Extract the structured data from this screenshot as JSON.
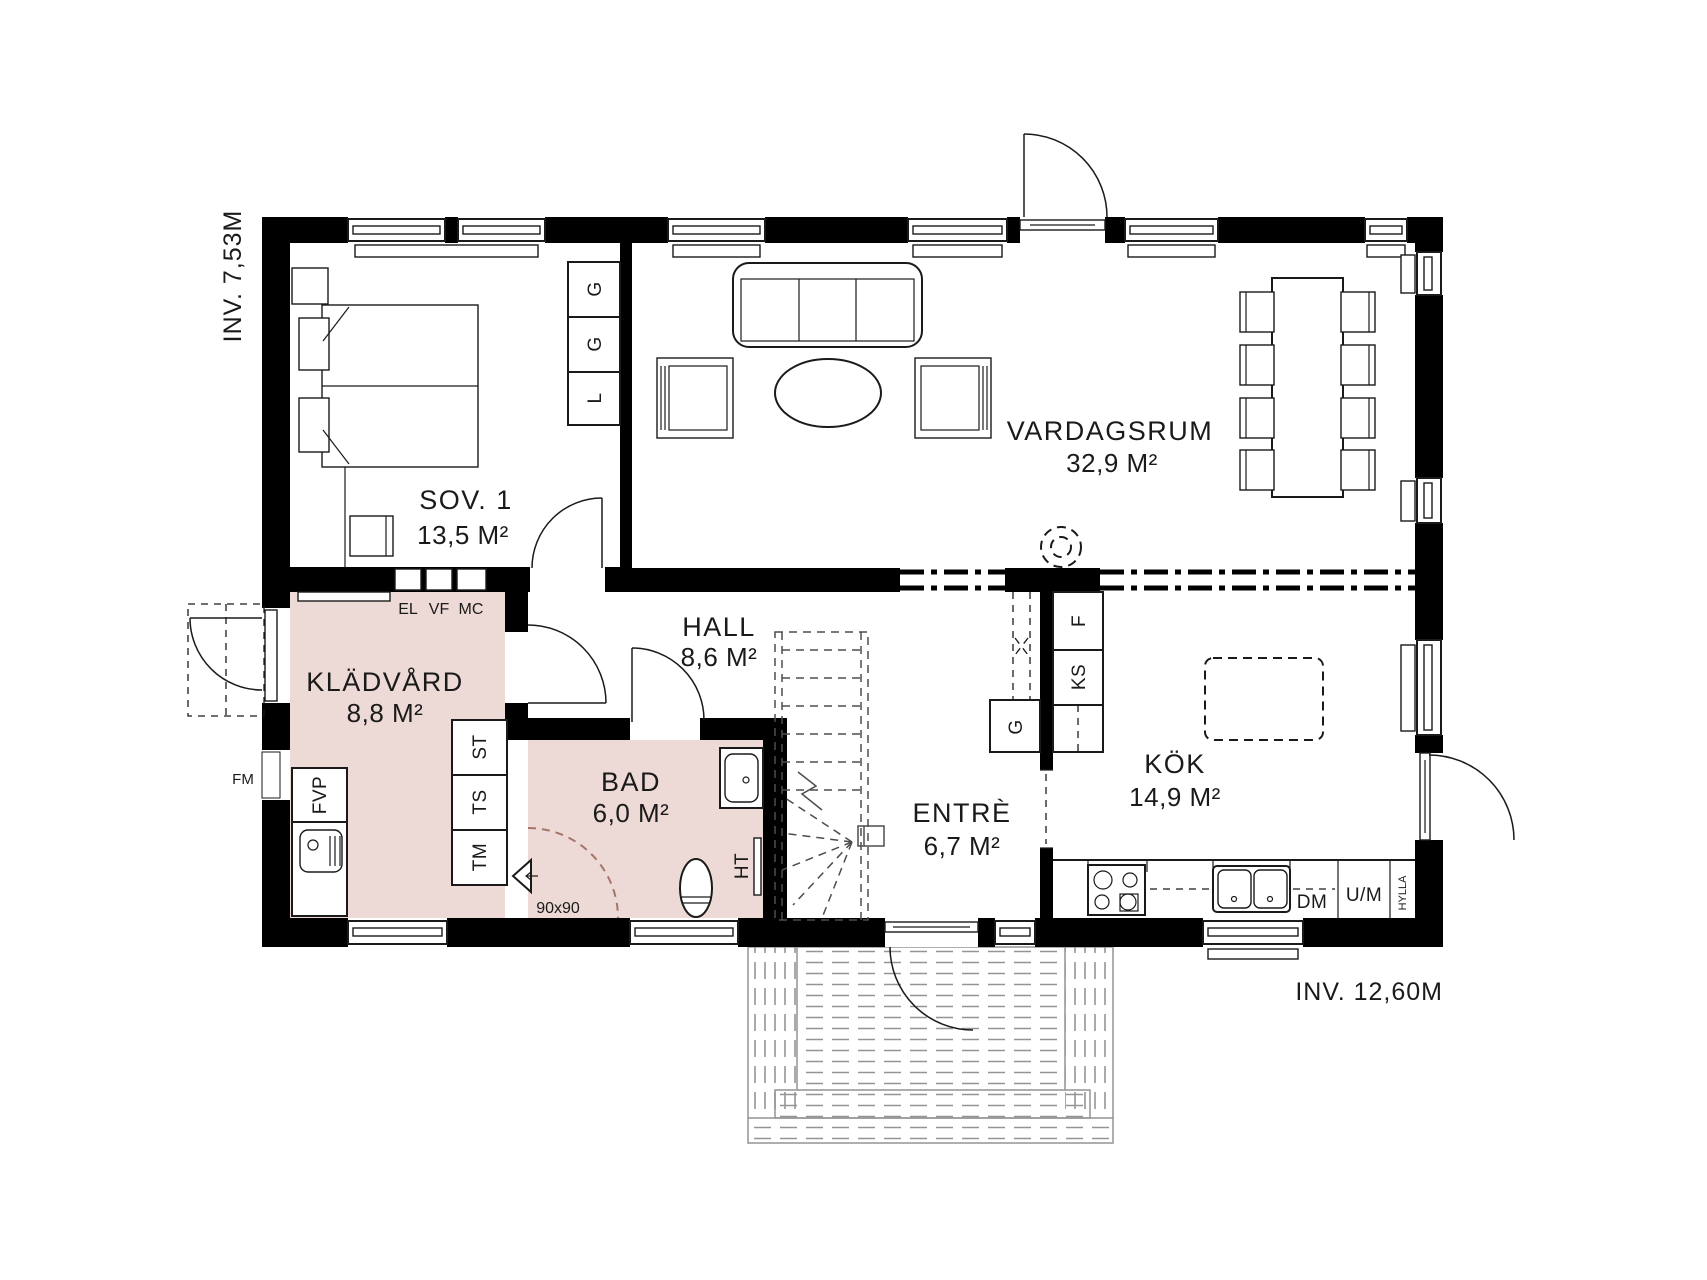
{
  "plan": {
    "dimensions": {
      "height_label": "INV. 7,53M",
      "width_label": "INV. 12,60M"
    },
    "rooms": [
      {
        "id": "sov1",
        "name": "SOV. 1",
        "area": "13,5 M²"
      },
      {
        "id": "vardagsrum",
        "name": "VARDAGSRUM",
        "area": "32,9 M²"
      },
      {
        "id": "kladvard",
        "name": "KLÄDVÅRD",
        "area": "8,8 M²"
      },
      {
        "id": "hall",
        "name": "HALL",
        "area": "8,6 M²"
      },
      {
        "id": "bad",
        "name": "BAD",
        "area": "6,0 M²"
      },
      {
        "id": "entre",
        "name": "ENTRÈ",
        "area": "6,7 M²"
      },
      {
        "id": "kok",
        "name": "KÖK",
        "area": "14,9 M²"
      }
    ],
    "closets": [
      "G",
      "G",
      "L"
    ],
    "laundry": {
      "el": "EL",
      "vf": "VF",
      "mc": "MC",
      "fvp": "FVP",
      "st": "ST",
      "ts": "TS",
      "tm": "TM",
      "fm": "FM"
    },
    "kitchen": {
      "f": "F",
      "ks": "KS",
      "g": "G",
      "dm": "DM",
      "um": "U/M",
      "hylla": "HYLLA"
    },
    "bath": {
      "ht": "HT",
      "shower_size": "90x90"
    },
    "colors": {
      "wall": "#000000",
      "wet_room": "#edd9d5",
      "line": "#1a1a1a",
      "deck": "#949494"
    }
  }
}
